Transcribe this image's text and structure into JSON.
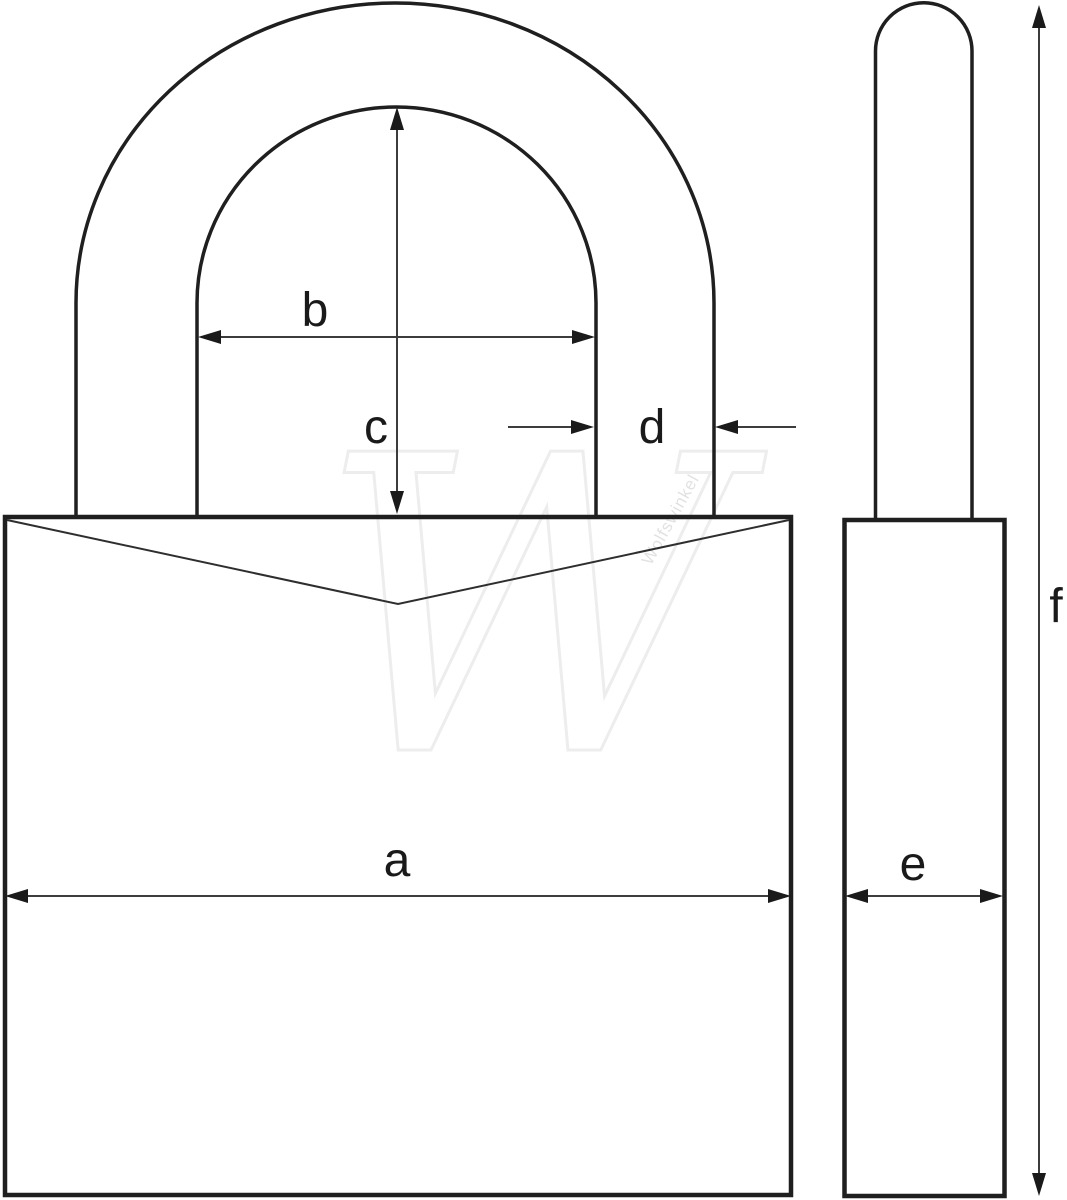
{
  "diagram": {
    "labels": {
      "a": "a",
      "b": "b",
      "c": "c",
      "d": "d",
      "e": "e",
      "f": "f"
    },
    "watermark": {
      "letter": "W",
      "text": "Wolfswinkel"
    },
    "colors": {
      "background": "#ffffff",
      "outline": "#1f1f1f",
      "dimension_line": "#3c3c3c",
      "label_text": "#1a1a1a",
      "watermark": "#ededed"
    }
  }
}
